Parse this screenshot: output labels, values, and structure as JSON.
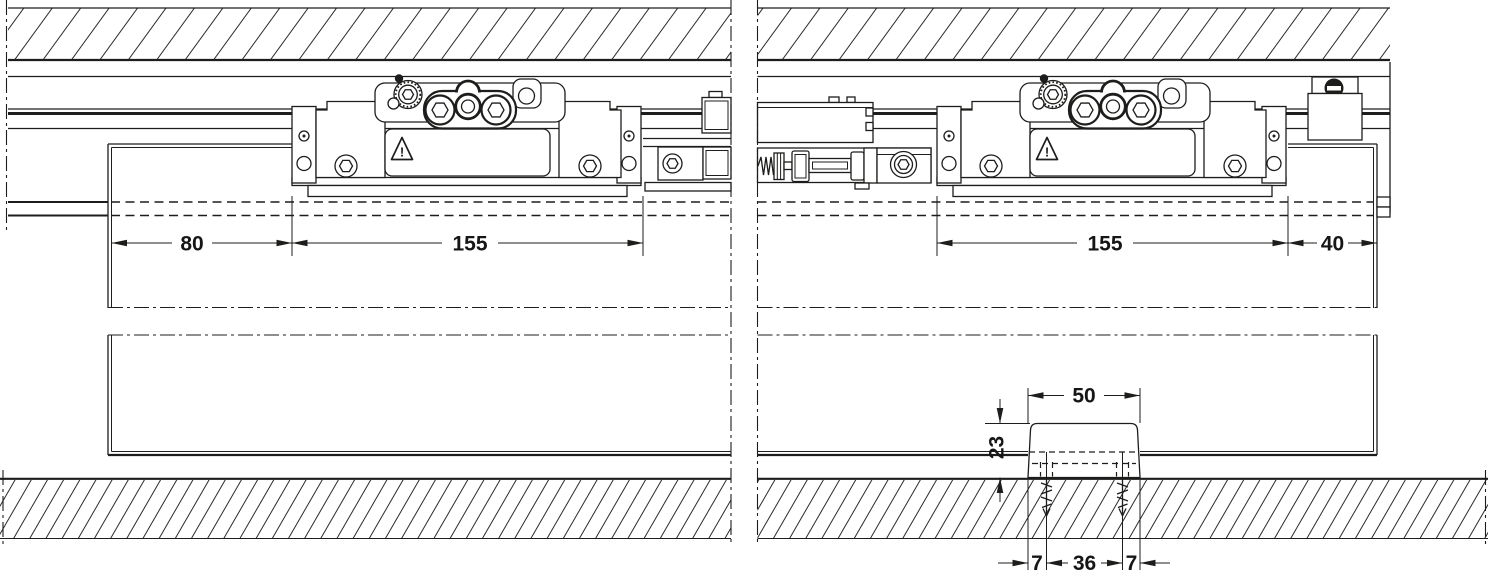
{
  "drawing": {
    "background": "#ffffff",
    "line_color": "#1d1d1b",
    "dimensions": {
      "door_left_to_carriage": "80",
      "carriage_left_length": "155",
      "carriage_right_length": "155",
      "carriage_to_door_right": "40",
      "floor_guide_width": "50",
      "floor_guide_height": "23",
      "guide_screw_left_offset": "7",
      "guide_screw_spacing": "36",
      "guide_screw_right_offset": "7"
    },
    "warning_label": "!"
  }
}
